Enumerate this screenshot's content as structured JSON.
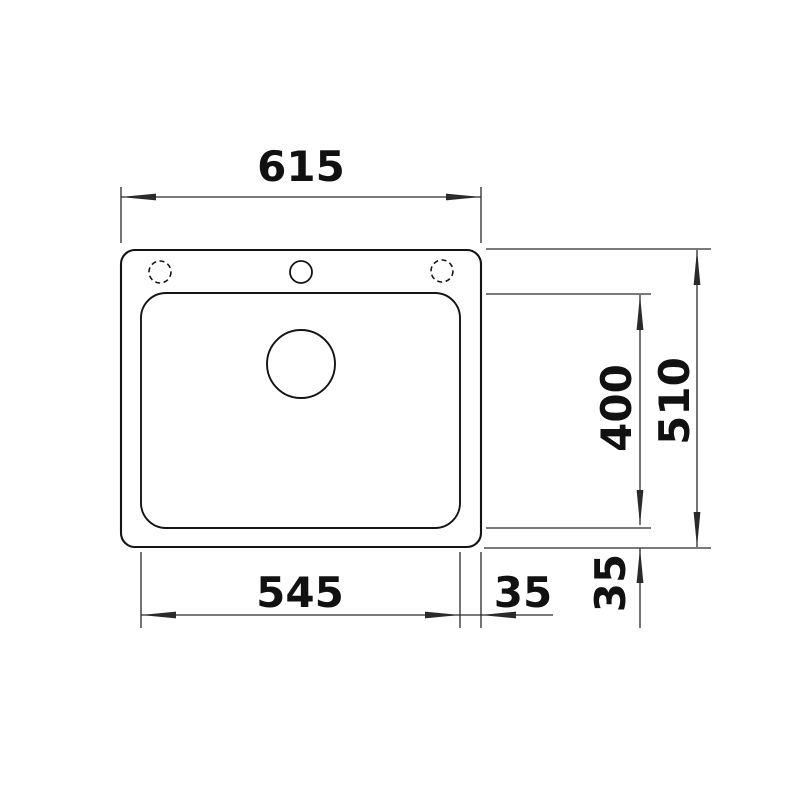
{
  "drawing": {
    "type": "technical-dimension-drawing",
    "view": "sink-top-view",
    "dimensions": {
      "overall_width": {
        "value": 615,
        "label": "615"
      },
      "basin_width": {
        "value": 545,
        "label": "545"
      },
      "right_edge_offset": {
        "value": 35,
        "label": "35"
      },
      "basin_depth": {
        "value": 400,
        "label": "400"
      },
      "overall_depth": {
        "value": 510,
        "label": "510"
      },
      "bottom_edge_offset": {
        "value": 35,
        "label": "35"
      }
    }
  },
  "colors": {
    "background": "#ffffff",
    "outline": "#141414",
    "dimension": "#2a2a2a",
    "text": "#111111"
  }
}
